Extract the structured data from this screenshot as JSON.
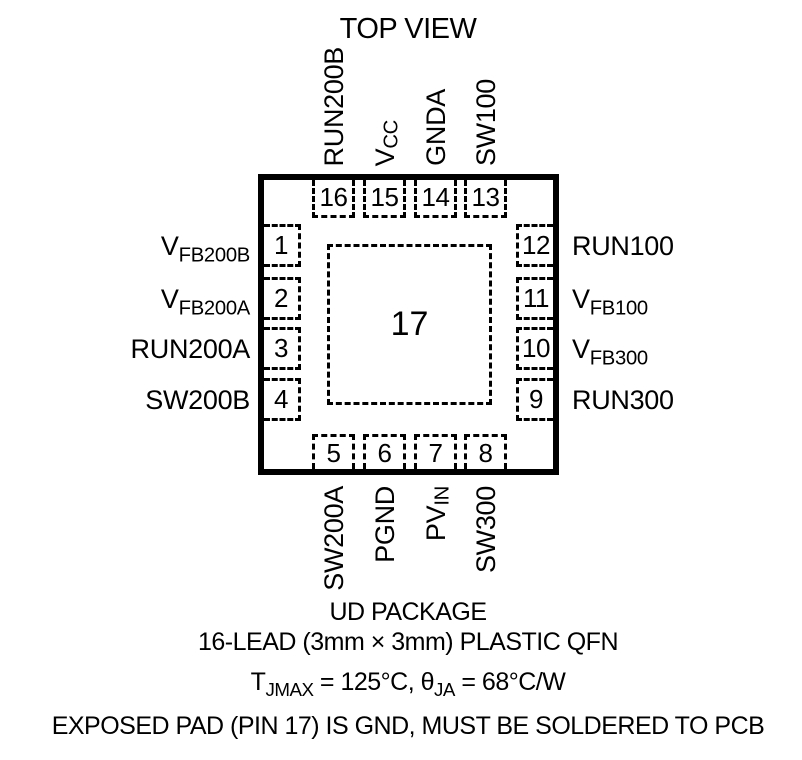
{
  "title": "TOP VIEW",
  "package": {
    "center_pad": {
      "num": "17"
    },
    "pins_top": [
      {
        "num": "16",
        "label": {
          "pre": "RUN200B",
          "sub": ""
        }
      },
      {
        "num": "15",
        "label": {
          "pre": "V",
          "sub": "CC"
        }
      },
      {
        "num": "14",
        "label": {
          "pre": "GNDA",
          "sub": ""
        }
      },
      {
        "num": "13",
        "label": {
          "pre": "SW100",
          "sub": ""
        }
      }
    ],
    "pins_bottom": [
      {
        "num": "5",
        "label": {
          "pre": "SW200A",
          "sub": ""
        }
      },
      {
        "num": "6",
        "label": {
          "pre": "PGND",
          "sub": ""
        }
      },
      {
        "num": "7",
        "label": {
          "pre": "PV",
          "sub": "IN"
        }
      },
      {
        "num": "8",
        "label": {
          "pre": "SW300",
          "sub": ""
        }
      }
    ],
    "pins_left": [
      {
        "num": "1",
        "label": {
          "pre": "V",
          "sub": "FB200B"
        }
      },
      {
        "num": "2",
        "label": {
          "pre": "V",
          "sub": "FB200A"
        }
      },
      {
        "num": "3",
        "label": {
          "pre": "RUN200A",
          "sub": ""
        }
      },
      {
        "num": "4",
        "label": {
          "pre": "SW200B",
          "sub": ""
        }
      }
    ],
    "pins_right": [
      {
        "num": "12",
        "label": {
          "pre": "RUN100",
          "sub": ""
        }
      },
      {
        "num": "11",
        "label": {
          "pre": "V",
          "sub": "FB100"
        }
      },
      {
        "num": "10",
        "label": {
          "pre": "V",
          "sub": "FB300"
        }
      },
      {
        "num": "9",
        "label": {
          "pre": "RUN300",
          "sub": ""
        }
      }
    ]
  },
  "footer": {
    "line1": "UD PACKAGE",
    "line2": "16-LEAD (3mm × 3mm) PLASTIC QFN",
    "line3": [
      {
        "t": "T"
      },
      {
        "s": "JMAX"
      },
      {
        "t": " = 125°C, θ"
      },
      {
        "s": "JA"
      },
      {
        "t": " = 68°C/W"
      }
    ],
    "line4": "EXPOSED PAD (PIN 17) IS GND, MUST BE SOLDERED TO PCB"
  },
  "colors": {
    "ink": "#000000",
    "background": "#ffffff"
  }
}
